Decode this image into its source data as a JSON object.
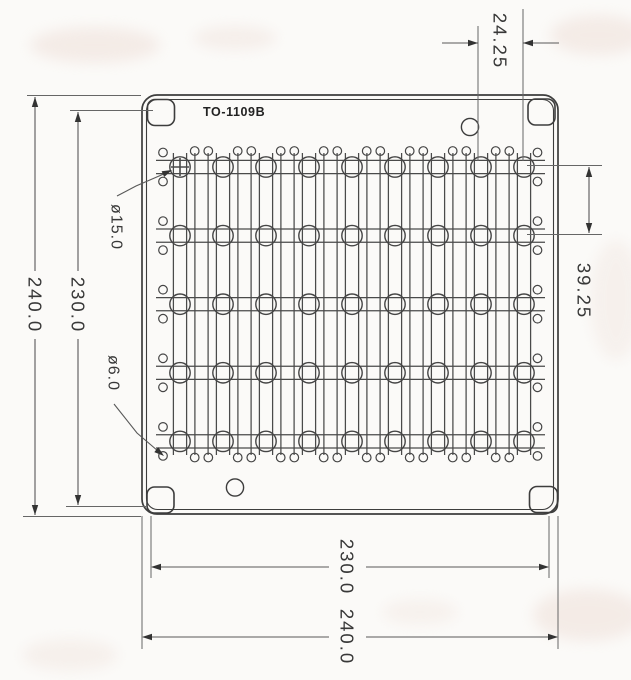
{
  "page": {
    "background": "#fbfaf8"
  },
  "drawing": {
    "part_label": "TO-1109B",
    "grid": {
      "rows": 5,
      "columns": 9
    },
    "dimensions": {
      "overall_height": "240.0",
      "inner_height": "230.0",
      "inner_width": "230.0",
      "overall_width": "240.0",
      "column_pitch": "24.25",
      "row_pitch": "39.25",
      "large_hole_diameter": "ø15.0",
      "small_hole_diameter": "ø6.0"
    }
  }
}
